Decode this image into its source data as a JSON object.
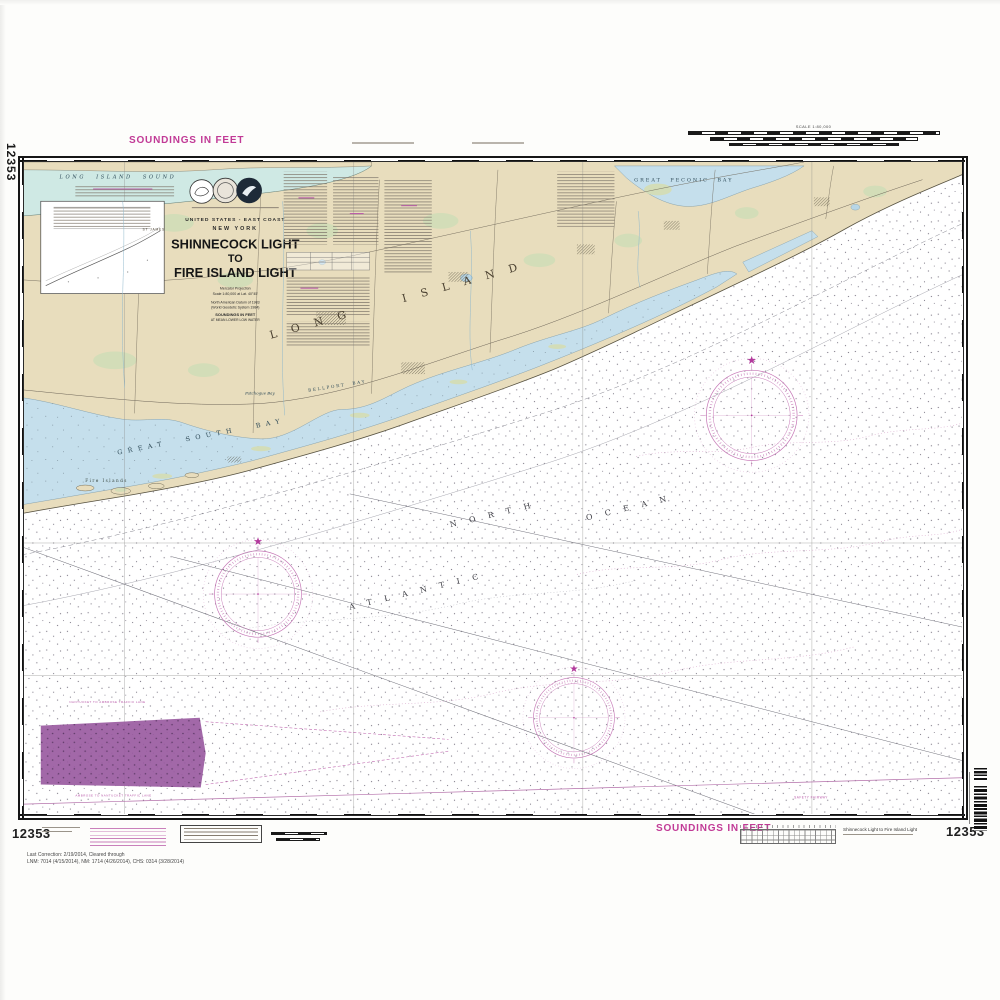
{
  "page": {
    "soundings_top": "SOUNDINGS IN FEET",
    "soundings_bottom": "SOUNDINGS IN FEET",
    "chart_number": "12353",
    "scale_label": "SCALE 1:80,000",
    "bottom_title": "Shinnecock Light to Fire Island Light",
    "correction_line1": "Last Correction: 2/19/2014,  Cleared through",
    "correction_line2": "LNM: 7014 (4/15/2014), NM: 1714 (4/26/2014), CHS: 0314 (3/28/2014)"
  },
  "title_block": {
    "region": "UNITED STATES - EAST COAST",
    "state": "NEW YORK",
    "title_line1": "SHINNECOCK LIGHT",
    "title_line2": "TO",
    "title_line3": "FIRE ISLAND LIGHT",
    "projection": "Mercator Projection",
    "scale": "Scale 1:80,000 at Lat. 40°45'",
    "datum": "North American Datum of 1983",
    "datum2": "(World Geodetic System 1984)",
    "soundings": "SOUNDINGS IN FEET",
    "soundings2": "AT MEAN LOWER LOW WATER"
  },
  "map_labels": {
    "long_island_sound": "LONG ISLAND SOUND",
    "great_peconic_bay": "GREAT PECONIC BAY",
    "long_island": "LONG ISLAND",
    "great_south_bay": "GREAT SOUTH BAY",
    "bellport_bay": "BELLPORT BAY",
    "patchogue_bay": "Patchogue Bay",
    "fire_islands": "Fire Islands",
    "st_james": "ST JAMES",
    "north": "NORTH",
    "atlantic": "ATLANTIC",
    "ocean": "OCEAN",
    "lane_north": "NANTUCKET TO AMBROSE TRAFFIC LANE",
    "lane_south": "AMBROSE TO NANTUCKET TRAFFIC LANE",
    "safety_fairway": "SAFETY FAIRWAY"
  },
  "colors": {
    "land": "#e8ddbd",
    "bay_water": "#c5dfec",
    "sound_water": "#cfe9e4",
    "magenta_label": "#c13a96",
    "rose_magenta": "#c473b4",
    "restricted_purple": "#9a5ba1"
  }
}
